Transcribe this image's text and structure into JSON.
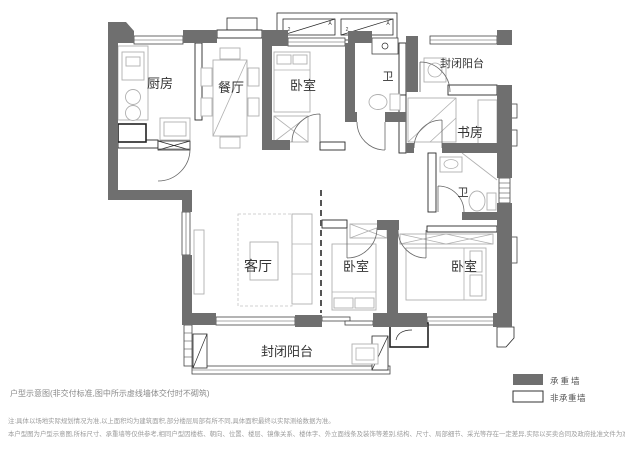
{
  "plan": {
    "rooms": [
      {
        "name": "kitchen",
        "label": "厨房"
      },
      {
        "name": "dining",
        "label": "餐厅"
      },
      {
        "name": "bedroom-north",
        "label": "卧室"
      },
      {
        "name": "bath-north",
        "label": "卫"
      },
      {
        "name": "balcony-northeast",
        "label": "封闭阳台"
      },
      {
        "name": "study",
        "label": "书房"
      },
      {
        "name": "bath-east",
        "label": "卫"
      },
      {
        "name": "living-room",
        "label": "客厅"
      },
      {
        "name": "bedroom-south",
        "label": "卧室"
      },
      {
        "name": "bedroom-southeast",
        "label": "卧室"
      },
      {
        "name": "balcony-south",
        "label": "封闭阳台"
      }
    ],
    "ac_platform_marks": [
      "2",
      "A",
      "2",
      "A"
    ]
  },
  "legend": {
    "items": [
      {
        "label": "承重墙",
        "style": "filled"
      },
      {
        "label": "非承重墙",
        "style": "outlined"
      }
    ]
  },
  "caption": "户型示意图(非交付标准,图中所示虚线墙体交付时不砌筑)",
  "notes": [
    "注:具体以场地实际规划情况为准,以上面积均为建筑面积,部分楼层局部有所不同,具体面积最终以实际测绘数据为准。",
    "本户型图为户型示意图,所标尺寸、承重墙等仅供参考,相同户型因楼栋、朝向、位置、楼层、镜像关系、楼体字、外立面线条及装饰等差别,结构、尺寸、局部细节、采光等存在一定差异,实际以买卖合同及政府批准文件为准。"
  ],
  "colors": {
    "load_bearing_wall": "#6f6f6f",
    "non_load_bearing_wall": "#ffffff",
    "background": "#ffffff",
    "label_text": "#333333",
    "note_text": "#9c9c9c"
  }
}
